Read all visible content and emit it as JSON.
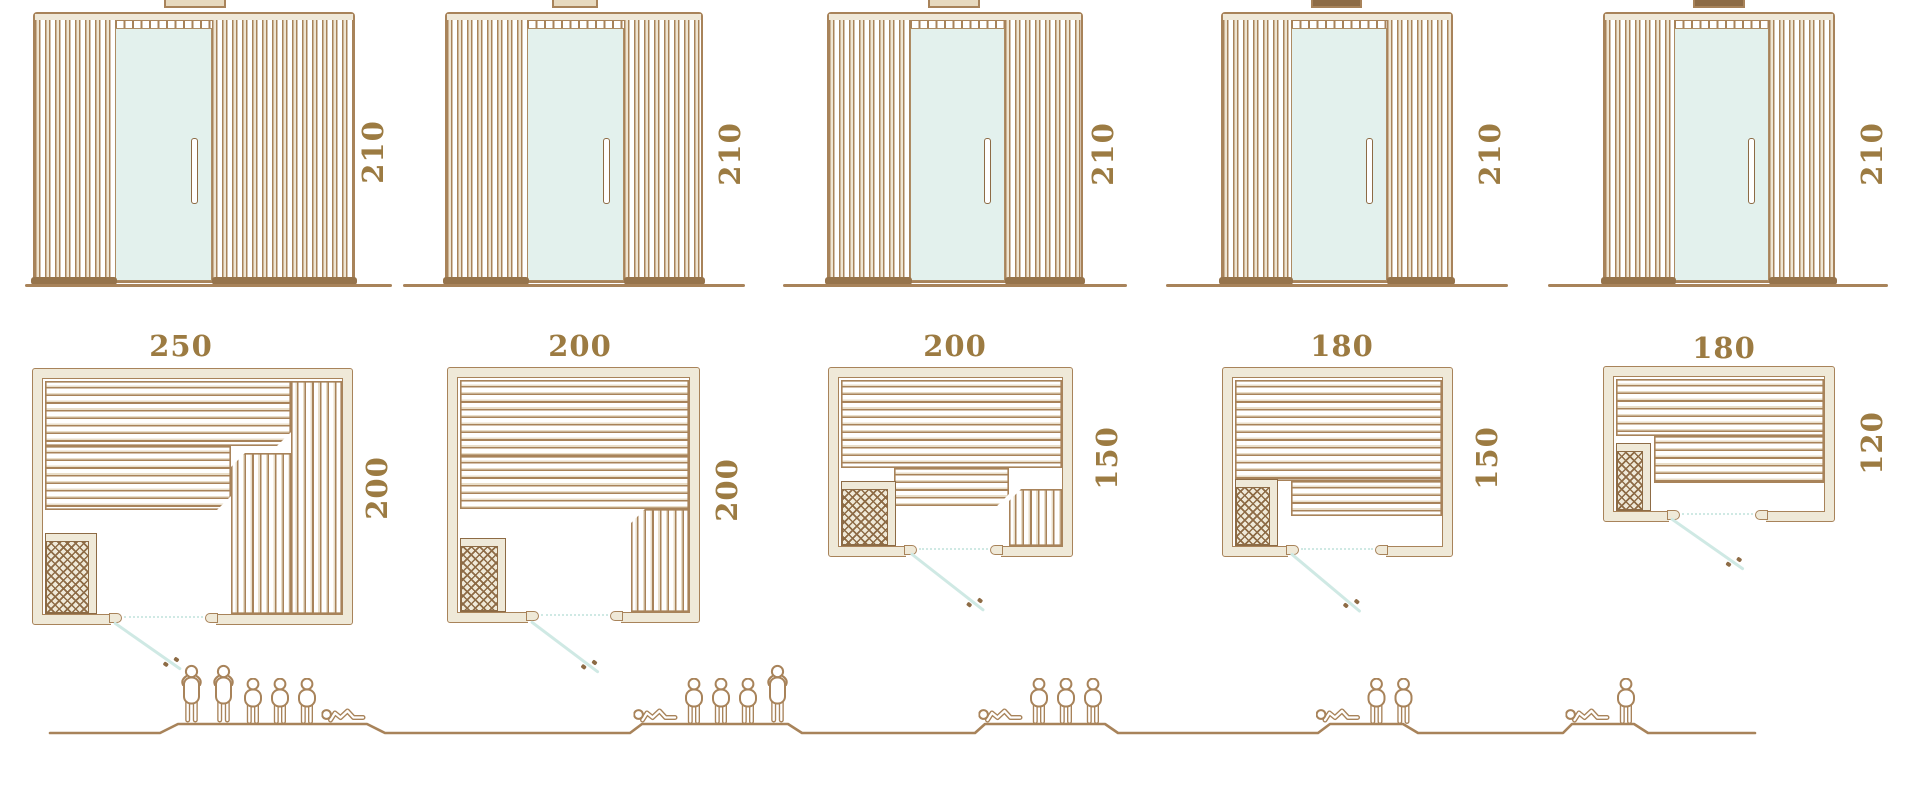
{
  "diagram": {
    "kind": "sauna-cabin-size-lineup",
    "colors": {
      "line_brown": "#A8835A",
      "dark_brown": "#8D6B45",
      "label_text": "#9C7B42",
      "wall_fill": "#EFE9D8",
      "glass": "#E3F1ED",
      "door_swing": "#CFE9E4",
      "plank_shade": "#E9DEC9"
    },
    "columns": [
      {
        "model": "250 x 200",
        "elevation": {
          "height_cm": "210"
        },
        "plan": {
          "width_cm": "250",
          "depth_cm": "200"
        },
        "capacity": {
          "count": 6,
          "people": [
            "standing",
            "standing",
            "seated",
            "seated",
            "seated",
            "lying"
          ]
        }
      },
      {
        "model": "200 x 200",
        "elevation": {
          "height_cm": "210"
        },
        "plan": {
          "width_cm": "200",
          "depth_cm": "200"
        },
        "capacity": {
          "count": 5,
          "people": [
            "lying",
            "seated",
            "seated",
            "seated",
            "standing"
          ]
        }
      },
      {
        "model": "200 x 150",
        "elevation": {
          "height_cm": "210"
        },
        "plan": {
          "width_cm": "200",
          "depth_cm": "150"
        },
        "capacity": {
          "count": 4,
          "people": [
            "lying",
            "seated",
            "seated",
            "seated"
          ]
        }
      },
      {
        "model": "180 x 150",
        "elevation": {
          "height_cm": "210"
        },
        "plan": {
          "width_cm": "180",
          "depth_cm": "150"
        },
        "capacity": {
          "count": 3,
          "people": [
            "lying",
            "seated",
            "seated"
          ]
        }
      },
      {
        "model": "180 x 120",
        "elevation": {
          "height_cm": "210"
        },
        "plan": {
          "width_cm": "180",
          "depth_cm": "120"
        },
        "capacity": {
          "count": 2,
          "people": [
            "lying",
            "seated"
          ]
        }
      }
    ]
  }
}
